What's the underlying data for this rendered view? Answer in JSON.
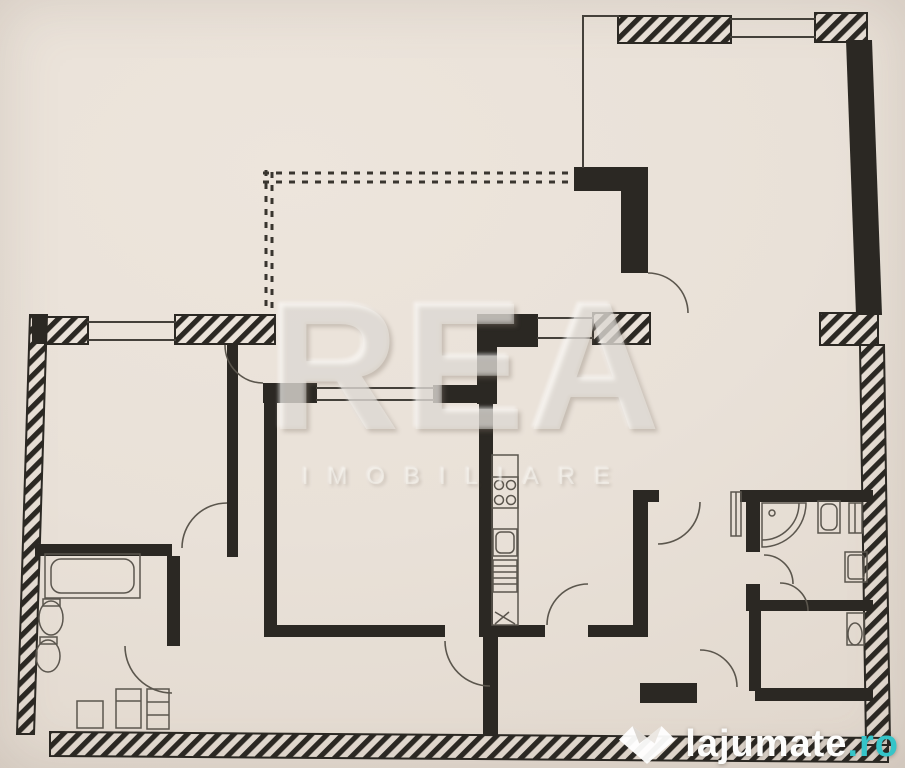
{
  "watermarks": {
    "agency": {
      "title": "REA",
      "subtitle": "IMOBILIARE"
    },
    "portal": {
      "name": "lajumate",
      "tld": ".ro",
      "accent": "#35c4c8"
    }
  },
  "colors": {
    "paper": "#e9e1d8",
    "ink": "#2b2823"
  },
  "plan": {
    "dashed": [
      {
        "n": "balcony-edge-top-a",
        "t": "line",
        "x1": 263,
        "y1": 173,
        "x2": 577,
        "y2": 173
      },
      {
        "n": "balcony-edge-top-b",
        "t": "line",
        "x1": 263,
        "y1": 182,
        "x2": 577,
        "y2": 182
      },
      {
        "n": "balcony-edge-left-a",
        "t": "line",
        "x1": 266,
        "y1": 170,
        "x2": 266,
        "y2": 310
      },
      {
        "n": "balcony-edge-left-b",
        "t": "line",
        "x1": 272,
        "y1": 172,
        "x2": 272,
        "y2": 308
      }
    ],
    "hatched": [
      {
        "n": "living-top-wall-left",
        "t": "rect",
        "x": 618,
        "y": 16,
        "w": 113,
        "h": 27
      },
      {
        "n": "living-top-wall-right",
        "t": "rect",
        "x": 815,
        "y": 13,
        "w": 52,
        "h": 29
      },
      {
        "n": "living-right-wall-block",
        "t": "rect",
        "x": 820,
        "y": 313,
        "w": 58,
        "h": 32
      },
      {
        "n": "right-exterior-wall",
        "t": "poly",
        "p": "860,345 884,345 890,745 866,745"
      },
      {
        "n": "bottom-exterior-wall",
        "t": "poly",
        "p": "50,732 888,738 888,762 50,756"
      },
      {
        "n": "left-exterior-wall",
        "t": "poly",
        "p": "30,315 47,315 34,734 17,734"
      },
      {
        "n": "bedroom1-top-wall-left",
        "t": "rect",
        "x": 45,
        "y": 317,
        "w": 43,
        "h": 27
      },
      {
        "n": "bedroom1-top-wall-right",
        "t": "rect",
        "x": 175,
        "y": 315,
        "w": 100,
        "h": 29
      },
      {
        "n": "kitchen-top-wall-block",
        "t": "rect",
        "x": 593,
        "y": 313,
        "w": 57,
        "h": 31
      }
    ],
    "solid": [
      {
        "n": "living-right-wall",
        "t": "poly",
        "p": "846,40 872,40 882,315 856,315"
      },
      {
        "n": "living-left-wall-top",
        "t": "rect",
        "x": 574,
        "y": 167,
        "w": 74,
        "h": 24
      },
      {
        "n": "living-left-wall",
        "t": "rect",
        "x": 621,
        "y": 190,
        "w": 27,
        "h": 83
      },
      {
        "n": "kitchen-top-wall",
        "t": "rect",
        "x": 477,
        "y": 314,
        "w": 61,
        "h": 33
      },
      {
        "n": "kitchen-left-wall-top",
        "t": "rect",
        "x": 477,
        "y": 346,
        "w": 20,
        "h": 58
      },
      {
        "n": "bedroom2-top-wall-left",
        "t": "rect",
        "x": 263,
        "y": 383,
        "w": 54,
        "h": 20
      },
      {
        "n": "bedroom2-top-wall-right",
        "t": "rect",
        "x": 433,
        "y": 385,
        "w": 58,
        "h": 18
      },
      {
        "n": "kitchen-left-wall",
        "t": "rect",
        "x": 479,
        "y": 403,
        "w": 14,
        "h": 234
      },
      {
        "n": "bedroom1-right-wall",
        "t": "rect",
        "x": 227,
        "y": 345,
        "w": 11,
        "h": 212
      },
      {
        "n": "bedroom2-left-wall",
        "t": "rect",
        "x": 264,
        "y": 403,
        "w": 13,
        "h": 234
      },
      {
        "n": "bedroom1-bottom-wall",
        "t": "rect",
        "x": 35,
        "y": 544,
        "w": 137,
        "h": 12
      },
      {
        "n": "bathroom1-right-wall",
        "t": "rect",
        "x": 167,
        "y": 556,
        "w": 13,
        "h": 90
      },
      {
        "n": "hall-bottom-wall-a",
        "t": "rect",
        "x": 277,
        "y": 625,
        "w": 168,
        "h": 12
      },
      {
        "n": "hall-bottom-wall-b",
        "t": "rect",
        "x": 490,
        "y": 625,
        "w": 55,
        "h": 12
      },
      {
        "n": "hall-bottom-wall-c",
        "t": "rect",
        "x": 588,
        "y": 625,
        "w": 57,
        "h": 12
      },
      {
        "n": "kitchen-right-wall",
        "t": "rect",
        "x": 633,
        "y": 490,
        "w": 15,
        "h": 147
      },
      {
        "n": "kitchen-right-stub",
        "t": "rect",
        "x": 633,
        "y": 490,
        "w": 26,
        "h": 12
      },
      {
        "n": "bath2-left-wall-top",
        "t": "rect",
        "x": 746,
        "y": 500,
        "w": 14,
        "h": 52
      },
      {
        "n": "bath2-left-wall-bottom",
        "t": "rect",
        "x": 746,
        "y": 584,
        "w": 14,
        "h": 27
      },
      {
        "n": "bath2-top-wall",
        "t": "rect",
        "x": 740,
        "y": 490,
        "w": 133,
        "h": 12
      },
      {
        "n": "bath2-bottom-wall",
        "t": "rect",
        "x": 755,
        "y": 600,
        "w": 118,
        "h": 11
      },
      {
        "n": "wc-left-wall",
        "t": "rect",
        "x": 749,
        "y": 611,
        "w": 12,
        "h": 80
      },
      {
        "n": "wc-bottom-wall",
        "t": "rect",
        "x": 755,
        "y": 688,
        "w": 118,
        "h": 13
      },
      {
        "n": "entry-wall",
        "t": "rect",
        "x": 640,
        "y": 683,
        "w": 57,
        "h": 20
      },
      {
        "n": "entry-divider-wall",
        "t": "rect",
        "x": 483,
        "y": 637,
        "w": 15,
        "h": 98
      },
      {
        "n": "corner-top-left",
        "t": "rect",
        "x": 32,
        "y": 316,
        "w": 15,
        "h": 28
      }
    ],
    "lines": [
      {
        "n": "living-top-thin",
        "t": "line",
        "x1": 583,
        "y1": 16,
        "x2": 618,
        "y2": 16
      },
      {
        "n": "living-left-thin",
        "t": "line",
        "x1": 583,
        "y1": 16,
        "x2": 583,
        "y2": 167
      },
      {
        "n": "window-living-a",
        "t": "line",
        "x1": 731,
        "y1": 19,
        "x2": 815,
        "y2": 19
      },
      {
        "n": "window-living-b",
        "t": "line",
        "x1": 731,
        "y1": 37,
        "x2": 815,
        "y2": 37
      },
      {
        "n": "window-bedroom1-a",
        "t": "line",
        "x1": 88,
        "y1": 322,
        "x2": 175,
        "y2": 322
      },
      {
        "n": "window-bedroom1-b",
        "t": "line",
        "x1": 88,
        "y1": 340,
        "x2": 175,
        "y2": 340
      },
      {
        "n": "window-kitchen-a",
        "t": "line",
        "x1": 538,
        "y1": 318,
        "x2": 593,
        "y2": 318
      },
      {
        "n": "window-kitchen-b",
        "t": "line",
        "x1": 538,
        "y1": 338,
        "x2": 593,
        "y2": 338
      },
      {
        "n": "window-bedroom2-a",
        "t": "line",
        "x1": 317,
        "y1": 388,
        "x2": 433,
        "y2": 388
      },
      {
        "n": "window-bedroom2-b",
        "t": "line",
        "x1": 317,
        "y1": 400,
        "x2": 433,
        "y2": 400
      }
    ],
    "arcs": [
      {
        "n": "door-living-balcony",
        "t": "path",
        "d": "M 648,273 A 40 40 0 0 1 688,313"
      },
      {
        "n": "door-bedroom1-top",
        "t": "path",
        "d": "M 225,345 A 38 38 0 0 0 263,383"
      },
      {
        "n": "door-bedroom1-bottom",
        "t": "path",
        "d": "M 182,548 A 45 45 0 0 1 227,503"
      },
      {
        "n": "door-bathroom1",
        "t": "path",
        "d": "M 125,646 A 47 47 0 0 0 172,693"
      },
      {
        "n": "door-bedroom2",
        "t": "path",
        "d": "M 445,641 A 45 45 0 0 0 490,686"
      },
      {
        "n": "door-kitchen",
        "t": "path",
        "d": "M 547,625 A 41 41 0 0 1 588,584"
      },
      {
        "n": "door-hallway",
        "t": "path",
        "d": "M 700,502 A 42 42 0 0 1 658,544"
      },
      {
        "n": "door-bathroom2",
        "t": "path",
        "d": "M 764,555 A 29 29 0 0 1 793,584"
      },
      {
        "n": "door-wc",
        "t": "path",
        "d": "M 780,583 A 28 28 0 0 1 808,611"
      },
      {
        "n": "door-entry",
        "t": "path",
        "d": "M 700,650 A 37 37 0 0 1 737,687"
      }
    ],
    "fixtures": [
      {
        "n": "bathtub",
        "t": "rect",
        "x": 45,
        "y": 554,
        "w": 95,
        "h": 44
      },
      {
        "n": "bathtub-inner",
        "t": "rect",
        "x": 51,
        "y": 559,
        "w": 83,
        "h": 34,
        "rx": 10
      },
      {
        "n": "toilet-tank",
        "t": "rect",
        "x": 43,
        "y": 599,
        "w": 17,
        "h": 7
      },
      {
        "n": "toilet-bowl",
        "t": "ellipse",
        "cx": 51,
        "cy": 618,
        "rx": 12,
        "ry": 17
      },
      {
        "n": "bidet-tank",
        "t": "rect",
        "x": 40,
        "y": 637,
        "w": 17,
        "h": 7
      },
      {
        "n": "bidet-bowl",
        "t": "ellipse",
        "cx": 48,
        "cy": 656,
        "rx": 12,
        "ry": 16
      },
      {
        "n": "cabinet-a",
        "t": "rect",
        "x": 77,
        "y": 701,
        "w": 26,
        "h": 27
      },
      {
        "n": "cabinet-b",
        "t": "rect",
        "x": 116,
        "y": 689,
        "w": 25,
        "h": 39
      },
      {
        "n": "cabinet-b-shelf",
        "t": "line",
        "x1": 116,
        "y1": 701,
        "x2": 141,
        "y2": 701
      },
      {
        "n": "cabinet-c",
        "t": "rect",
        "x": 147,
        "y": 689,
        "w": 22,
        "h": 40
      },
      {
        "n": "cabinet-c-shelf1",
        "t": "line",
        "x1": 147,
        "y1": 702,
        "x2": 169,
        "y2": 702
      },
      {
        "n": "cabinet-c-shelf2",
        "t": "line",
        "x1": 147,
        "y1": 715,
        "x2": 169,
        "y2": 715
      },
      {
        "n": "kitchen-counter",
        "t": "rect",
        "x": 492,
        "y": 455,
        "w": 26,
        "h": 170
      },
      {
        "n": "stove",
        "t": "rect",
        "x": 492,
        "y": 477,
        "w": 26,
        "h": 31
      },
      {
        "n": "stove-burner-1",
        "t": "circle",
        "cx": 499,
        "cy": 485,
        "r": 4.5
      },
      {
        "n": "stove-burner-2",
        "t": "circle",
        "cx": 511,
        "cy": 485,
        "r": 4.5
      },
      {
        "n": "stove-burner-3",
        "t": "circle",
        "cx": 499,
        "cy": 500,
        "r": 4.5
      },
      {
        "n": "stove-burner-4",
        "t": "circle",
        "cx": 511,
        "cy": 500,
        "r": 4.5
      },
      {
        "n": "kitchen-sink",
        "t": "rect",
        "x": 493,
        "y": 529,
        "w": 24,
        "h": 27
      },
      {
        "n": "kitchen-sink-basin",
        "t": "rect",
        "x": 496,
        "y": 532,
        "w": 18,
        "h": 21,
        "rx": 5
      },
      {
        "n": "kitchen-cabinet",
        "t": "rect",
        "x": 493,
        "y": 560,
        "w": 24,
        "h": 32
      },
      {
        "n": "kitchen-cabinet-l1",
        "t": "line",
        "x1": 493,
        "y1": 566,
        "x2": 517,
        "y2": 566
      },
      {
        "n": "kitchen-cabinet-l2",
        "t": "line",
        "x1": 493,
        "y1": 572,
        "x2": 517,
        "y2": 572
      },
      {
        "n": "kitchen-cabinet-l3",
        "t": "line",
        "x1": 493,
        "y1": 578,
        "x2": 517,
        "y2": 578
      },
      {
        "n": "kitchen-cabinet-l4",
        "t": "line",
        "x1": 493,
        "y1": 584,
        "x2": 517,
        "y2": 584
      },
      {
        "n": "counter-end-mark",
        "t": "path",
        "d": "M 495,612 L 515,624 M 495,624 L 509,612"
      },
      {
        "n": "hall-radiator",
        "t": "rect",
        "x": 731,
        "y": 492,
        "w": 10,
        "h": 44
      },
      {
        "n": "hall-radiator-line",
        "t": "line",
        "x1": 736,
        "y1": 492,
        "x2": 736,
        "y2": 536
      },
      {
        "n": "shower",
        "t": "path",
        "d": "M 762,503 L 806,503 A 44 44 0 0 1 762,547 Z"
      },
      {
        "n": "shower-inner",
        "t": "path",
        "d": "M 799,503 A 37 37 0 0 1 762,540"
      },
      {
        "n": "shower-drain",
        "t": "circle",
        "cx": 772,
        "cy": 513,
        "r": 3
      },
      {
        "n": "bath2-sink",
        "t": "rect",
        "x": 818,
        "y": 501,
        "w": 22,
        "h": 32
      },
      {
        "n": "bath2-sink-basin",
        "t": "rect",
        "x": 821,
        "y": 504,
        "w": 16,
        "h": 26,
        "rx": 6
      },
      {
        "n": "bath2-heater",
        "t": "rect",
        "x": 849,
        "y": 503,
        "w": 13,
        "h": 30
      },
      {
        "n": "bath2-heater-line",
        "t": "line",
        "x1": 855,
        "y1": 503,
        "x2": 855,
        "y2": 533
      },
      {
        "n": "washing-machine",
        "t": "rect",
        "x": 845,
        "y": 552,
        "w": 22,
        "h": 30
      },
      {
        "n": "washing-machine-inner",
        "t": "rect",
        "x": 848,
        "y": 555,
        "w": 16,
        "h": 24,
        "rx": 3
      },
      {
        "n": "wc-toilet",
        "t": "rect",
        "x": 847,
        "y": 613,
        "w": 17,
        "h": 32
      },
      {
        "n": "wc-toilet-bowl",
        "t": "ellipse",
        "cx": 855,
        "cy": 634,
        "rx": 7,
        "ry": 11
      }
    ]
  }
}
